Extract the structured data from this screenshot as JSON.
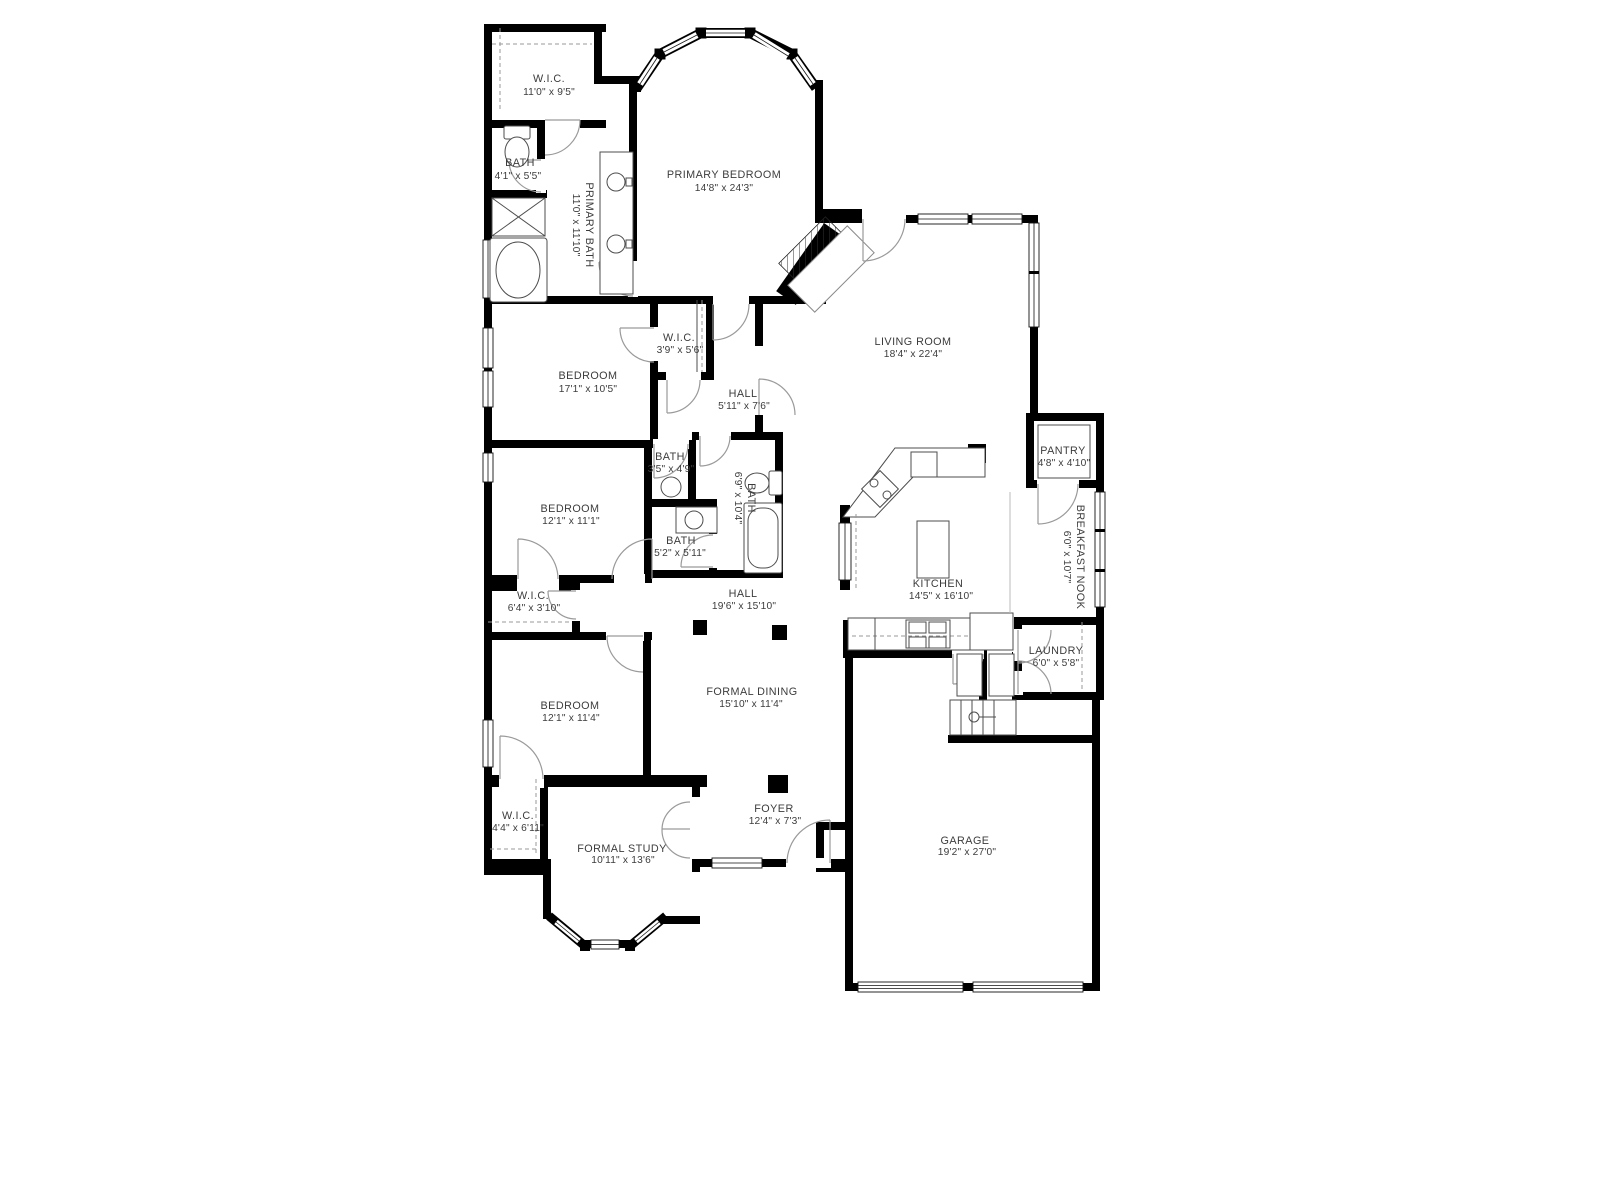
{
  "colors": {
    "wall": "#000000",
    "background": "#ffffff",
    "label": "#3c3c3c",
    "door_arc": "#9a9a9a"
  },
  "rooms": [
    {
      "name": "W.I.C.",
      "dims": "11'0\" x 9'5\""
    },
    {
      "name": "BATH",
      "dims": "4'1\" x 5'5\""
    },
    {
      "name": "PRIMARY BATH",
      "dims": "11'0\" x 11'10\""
    },
    {
      "name": "PRIMARY BEDROOM",
      "dims": "14'8\" x 24'3\""
    },
    {
      "name": "BEDROOM",
      "dims": "17'1\" x 10'5\""
    },
    {
      "name": "W.I.C.",
      "dims": "3'9\" x 5'6\""
    },
    {
      "name": "HALL",
      "dims": "5'11\" x 7'6\""
    },
    {
      "name": "LIVING ROOM",
      "dims": "18'4\" x 22'4\""
    },
    {
      "name": "PANTRY",
      "dims": "4'8\" x 4'10\""
    },
    {
      "name": "BATH",
      "dims": "3'5\" x 4'9\""
    },
    {
      "name": "BATH",
      "dims": "6'9\" x 10'4\""
    },
    {
      "name": "BEDROOM",
      "dims": "12'1\" x 11'1\""
    },
    {
      "name": "BATH",
      "dims": "5'2\" x 5'11\""
    },
    {
      "name": "BREAKFAST NOOK",
      "dims": "6'0\" x 10'7\""
    },
    {
      "name": "KITCHEN",
      "dims": "14'5\" x 16'10\""
    },
    {
      "name": "W.I.C.",
      "dims": "6'4\" x 3'10\""
    },
    {
      "name": "HALL",
      "dims": "19'6\" x 15'10\""
    },
    {
      "name": "LAUNDRY",
      "dims": "6'0\" x 5'8\""
    },
    {
      "name": "BEDROOM",
      "dims": "12'1\" x 11'4\""
    },
    {
      "name": "FORMAL DINING",
      "dims": "15'10\" x 11'4\""
    },
    {
      "name": "W.I.C.",
      "dims": "4'4\" x 6'11\""
    },
    {
      "name": "FORMAL STUDY",
      "dims": "10'11\" x 13'6\""
    },
    {
      "name": "FOYER",
      "dims": "12'4\" x 7'3\""
    },
    {
      "name": "GARAGE",
      "dims": "19'2\" x 27'0\""
    }
  ]
}
